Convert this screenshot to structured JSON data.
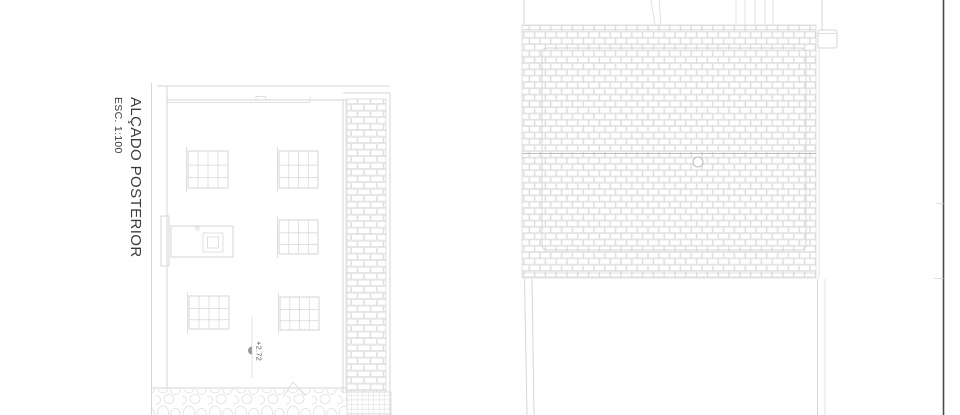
{
  "title_block": {
    "title": "ALÇADO POSTERIOR",
    "scale": "ESC. 1:100"
  },
  "elevation": {
    "level_marker": "+2.72"
  },
  "colors": {
    "bg": "#ffffff",
    "line": "#d6d6d6",
    "line-light": "#dcdcdc",
    "line-strong": "#bdbdbd",
    "sheet-edge": "#4a4a4a",
    "text": "#3c3c3c",
    "annot": "#5a5a5a"
  }
}
